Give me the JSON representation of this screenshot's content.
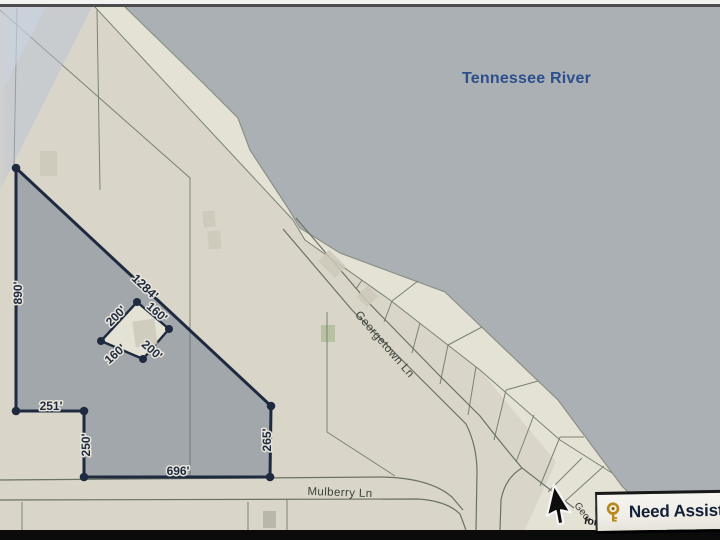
{
  "map": {
    "river_label": "Tennessee River",
    "roads": {
      "georgetown": "Georgetown Ln",
      "mulberry": "Mulberry Ln"
    },
    "fragments": {
      "road_fragment": "Geor",
      "text_fragment": "form"
    },
    "parcel": {
      "side_lengths": {
        "left": "890'",
        "diagonal": "1284'",
        "notch_top": "251'",
        "notch_left": "250'",
        "bottom": "696'",
        "right": "265'"
      },
      "inner_lot": {
        "top_left": "200'",
        "top_right": "160'",
        "bottom_left": "160'",
        "bottom_right": "200'"
      }
    }
  },
  "assist_bar": {
    "label": "Need Assist",
    "icon": "key-icon"
  },
  "colors": {
    "river": "#aab0b4",
    "land": "#d9d5c9",
    "land_light": "#e4e1d5",
    "parcel_fill": "rgba(86,105,132,0.42)",
    "parcel_line": "#1e2a40",
    "label_text": "#1e2a40",
    "river_text": "#2d4f8e",
    "road_line": "#6b7263",
    "lot_line": "#7b8273",
    "road_label": "#3b413a",
    "assist_text": "#13203a",
    "key_gold": "#b9891c",
    "bar_bg": "#f0eee7",
    "black_strip": "#0b0b0b"
  }
}
